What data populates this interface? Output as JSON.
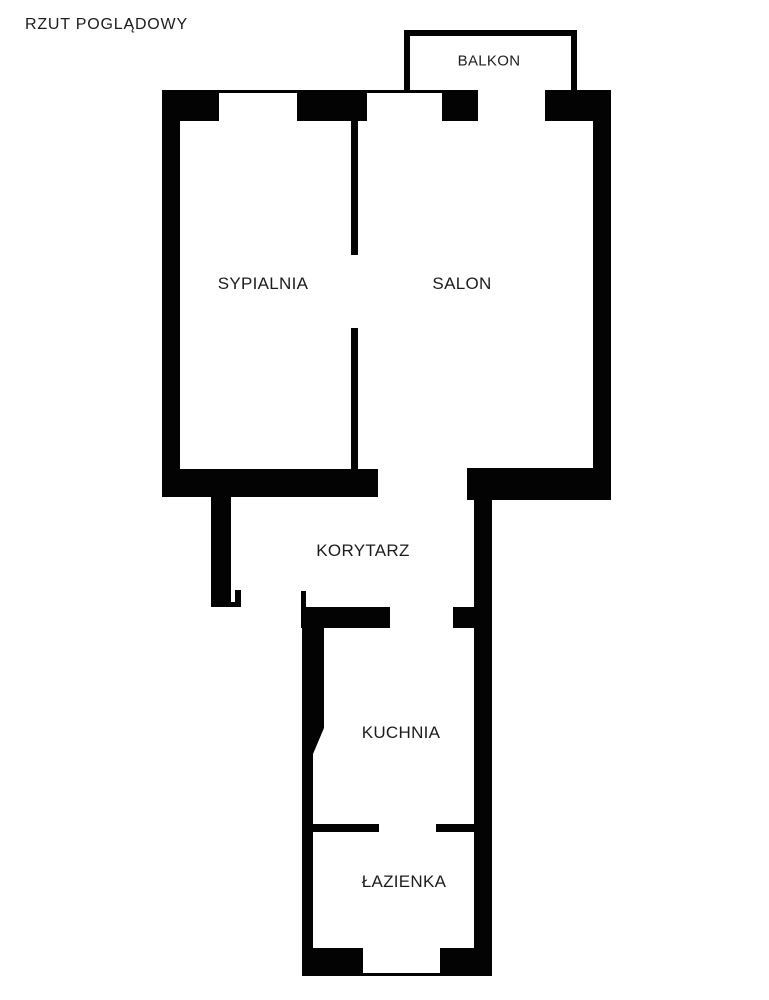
{
  "page": {
    "title": "RZUT POGLĄDOWY",
    "background_color": "#ffffff",
    "wall_color": "#030303",
    "text_color": "#1c1c1c"
  },
  "floorplan": {
    "rooms": [
      {
        "id": "balkon",
        "label": "BALKON",
        "cx": 489,
        "cy": 61,
        "font_size": 15
      },
      {
        "id": "sypialnia",
        "label": "SYPIALNIA",
        "cx": 263,
        "cy": 284,
        "font_size": 17
      },
      {
        "id": "salon",
        "label": "SALON",
        "cx": 462,
        "cy": 284,
        "font_size": 17
      },
      {
        "id": "korytarz",
        "label": "KORYTARZ",
        "cx": 363,
        "cy": 551,
        "font_size": 17
      },
      {
        "id": "kuchnia",
        "label": "KUCHNIA",
        "cx": 401,
        "cy": 733,
        "font_size": 17
      },
      {
        "id": "lazienka",
        "label": "ŁAZIENKA",
        "cx": 404,
        "cy": 882,
        "font_size": 17
      }
    ],
    "walls": [
      {
        "name": "balkon-north-wall",
        "x": 404,
        "y": 30,
        "w": 173,
        "h": 6
      },
      {
        "name": "balkon-west-wall",
        "x": 404,
        "y": 36,
        "w": 6,
        "h": 57
      },
      {
        "name": "balkon-east-wall",
        "x": 571,
        "y": 36,
        "w": 6,
        "h": 57
      },
      {
        "name": "top-outer-edge-left",
        "x": 162,
        "y": 90,
        "w": 316,
        "h": 3
      },
      {
        "name": "top-outer-edge-right",
        "x": 545,
        "y": 90,
        "w": 66,
        "h": 3
      },
      {
        "name": "top-wall-west",
        "x": 162,
        "y": 93,
        "w": 57,
        "h": 28
      },
      {
        "name": "top-wall-mid",
        "x": 297,
        "y": 93,
        "w": 70,
        "h": 28
      },
      {
        "name": "top-wall-balcony-left",
        "x": 442,
        "y": 93,
        "w": 36,
        "h": 28
      },
      {
        "name": "top-wall-east",
        "x": 545,
        "y": 93,
        "w": 66,
        "h": 28
      },
      {
        "name": "west-wall",
        "x": 162,
        "y": 121,
        "w": 18,
        "h": 376
      },
      {
        "name": "east-wall-upper",
        "x": 593,
        "y": 121,
        "w": 18,
        "h": 347
      },
      {
        "name": "sypialnia-salon-wall-upper",
        "x": 351,
        "y": 121,
        "w": 7,
        "h": 134
      },
      {
        "name": "sypialnia-salon-wall-lower",
        "x": 351,
        "y": 328,
        "w": 7,
        "h": 142
      },
      {
        "name": "sypialnia-south-wall",
        "x": 162,
        "y": 469,
        "w": 216,
        "h": 28
      },
      {
        "name": "salon-south-wall",
        "x": 467,
        "y": 468,
        "w": 144,
        "h": 32
      },
      {
        "name": "korytarz-west-wall",
        "x": 211,
        "y": 497,
        "w": 20,
        "h": 110
      },
      {
        "name": "entry-jamb-hook",
        "x": 230,
        "y": 602,
        "w": 11,
        "h": 5
      },
      {
        "name": "entry-jamb-left",
        "x": 235,
        "y": 590,
        "w": 6,
        "h": 17
      },
      {
        "name": "entry-jamb-right",
        "x": 301,
        "y": 591,
        "w": 5,
        "h": 16
      },
      {
        "name": "kuchnia-north-wall",
        "x": 301,
        "y": 607,
        "w": 89,
        "h": 21
      },
      {
        "name": "kuchnia-north-wall-stub",
        "x": 453,
        "y": 607,
        "w": 21,
        "h": 21
      },
      {
        "name": "east-wall-lower",
        "x": 474,
        "y": 500,
        "w": 18,
        "h": 476
      },
      {
        "name": "kuchnia-west-wall-upper",
        "x": 302,
        "y": 628,
        "w": 22,
        "h": 100
      },
      {
        "name": "kuchnia-west-wall-notch",
        "x": 302,
        "y": 728,
        "w": 22,
        "h": 26,
        "clip": "polygon(0 0, 100% 0, 50% 100%, 0 100%)"
      },
      {
        "name": "west-wall-lower",
        "x": 302,
        "y": 754,
        "w": 11,
        "h": 222
      },
      {
        "name": "kuchnia-lazienka-wall-west",
        "x": 313,
        "y": 824,
        "w": 66,
        "h": 8
      },
      {
        "name": "kuchnia-lazienka-wall-east",
        "x": 436,
        "y": 824,
        "w": 38,
        "h": 8
      },
      {
        "name": "lazienka-south-wall-west",
        "x": 302,
        "y": 948,
        "w": 61,
        "h": 25
      },
      {
        "name": "lazienka-south-wall-east",
        "x": 440,
        "y": 948,
        "w": 52,
        "h": 25
      },
      {
        "name": "lazienka-south-outer-edge",
        "x": 302,
        "y": 973,
        "w": 190,
        "h": 3
      }
    ]
  }
}
